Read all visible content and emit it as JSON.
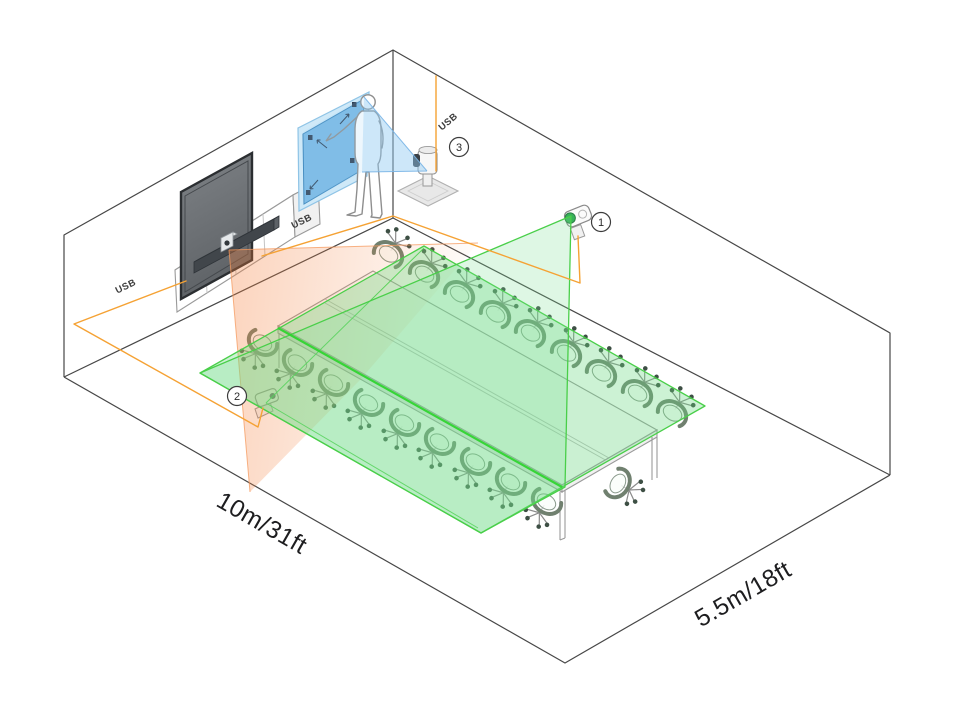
{
  "labels": {
    "room_length": "10m/31ft",
    "room_width": "5.5m/18ft",
    "usb": "USB"
  },
  "markers": {
    "camera_1": "1",
    "camera_2": "2",
    "content_camera": "3"
  },
  "colors": {
    "cable_orange": "#F5A234",
    "cone_orange": "#F47E3A",
    "coverage_green_stroke": "#49CF49",
    "coverage_green_fill": "#6AD882",
    "whiteboard_blue": "#79B9E4",
    "outline_dark": "#474747"
  }
}
